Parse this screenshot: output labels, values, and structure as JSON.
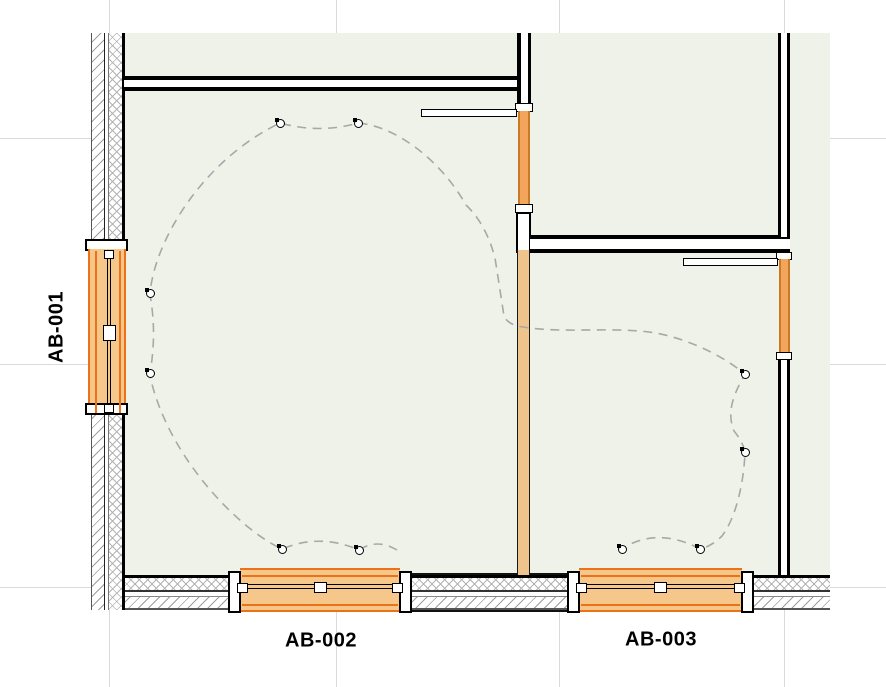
{
  "plan": {
    "labels": [
      {
        "id": "AB-001"
      },
      {
        "id": "AB-002"
      },
      {
        "id": "AB-003"
      }
    ],
    "grid": {
      "vertical": [
        109,
        336,
        559,
        784
      ],
      "horizontal": [
        138,
        364,
        587
      ]
    },
    "fixtures": [
      [
        280,
        123
      ],
      [
        358,
        123
      ],
      [
        150,
        293
      ],
      [
        150,
        373
      ],
      [
        282,
        549
      ],
      [
        359,
        550
      ],
      [
        622,
        549
      ],
      [
        700,
        549
      ],
      [
        745,
        374
      ],
      [
        745,
        452
      ]
    ],
    "route_path": "M 397 550 Q 377 538 359 550 Q 320 533 282 549 C 240 530 168 458 150 376 L 150 373 Q 157 333 150 295 L 150 293 C 155 240 203 160 280 123 Q 320 134 358 123 C 395 126 440 159 466 205 Q 486 224 495 258 Q 500 290 504 316 Q 508 325 523 327 C 565 334 612 326 656 333 C 692 340 724 357 745 374 C 734 394 726 411 734 431 Q 743 442 745 452 C 744 480 737 516 722 536 Q 712 546 700 549 C 678 537 649 531 622 549",
    "colors": {
      "floor": "#EFF2E9",
      "window_fill": "#F6C78A",
      "window_accent": "#ED7117",
      "door_fill": "#F3A65B",
      "door_accent": "#C97A26",
      "wall_column_fill": "#EFC38C",
      "route": "#A8A8A8",
      "grid": "#DADADA"
    }
  }
}
